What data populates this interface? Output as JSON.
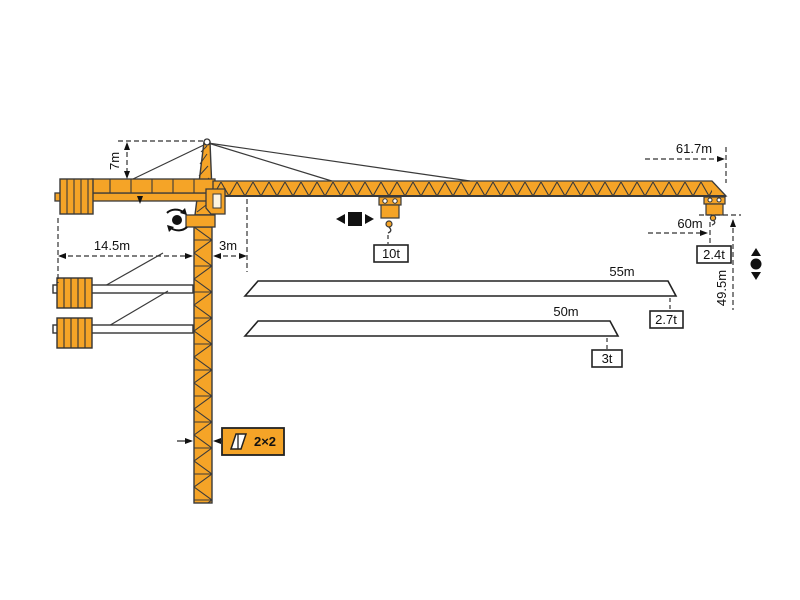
{
  "colors": {
    "crane": "#F5A427",
    "outline": "#3A3A3A",
    "text": "#111111",
    "background": "#FFFFFF"
  },
  "dimensions": {
    "head_height": "7m",
    "counterjib_radius": "14.5m",
    "min_radius": "3m",
    "max_radius": "61.7m",
    "radius_at_60m": "60m",
    "hook_height": "49.5m",
    "mast_section": "2×2"
  },
  "loads": {
    "max_capacity": "10t",
    "tip_load_main": "2.4t"
  },
  "jib_variants": [
    {
      "length": "55m",
      "tip_load": "2.7t"
    },
    {
      "length": "50m",
      "tip_load": "3t"
    }
  ],
  "symbols": {
    "slewing_icon": "rotation",
    "trolley_icon": "left-right-travel",
    "hoist_icon": "up-down-hoist",
    "section_icon": "mast-cross-section"
  }
}
